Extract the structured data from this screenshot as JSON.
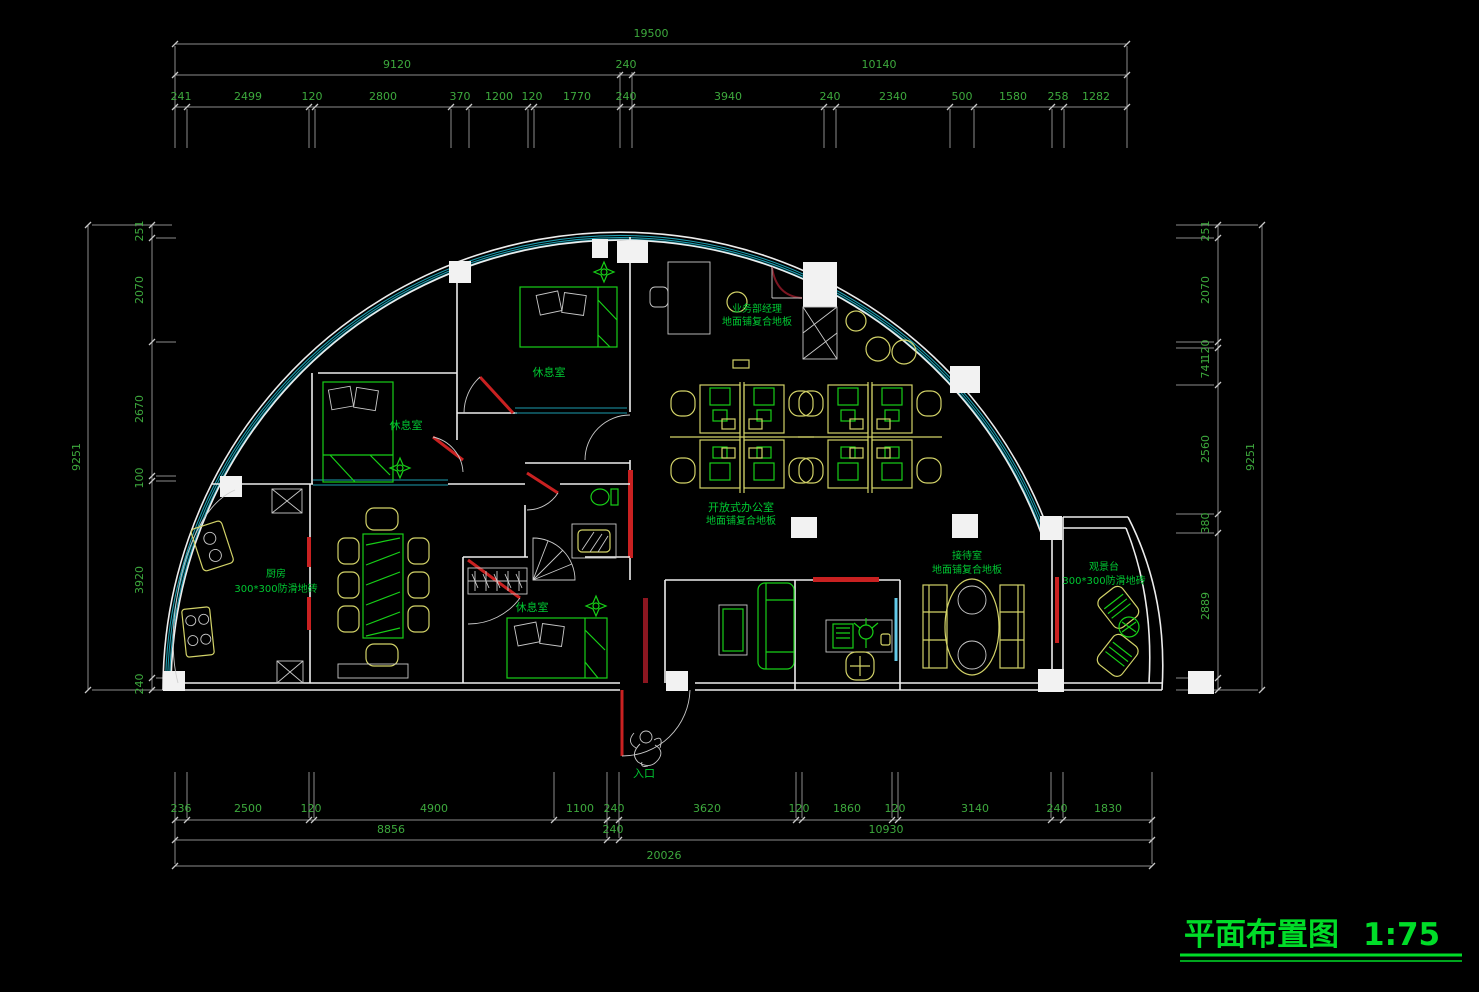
{
  "title": {
    "label": "平面布置图",
    "scale": "1:75"
  },
  "colors": {
    "background": "#000000",
    "dimension_text": "#3da93d",
    "dimension_line": "#8d8d8d",
    "wall": "#ededed",
    "window_teal": "#1d9cae",
    "glass_cyan": "#62c9e8",
    "furniture_yellow": "#d2d268",
    "furniture_green": "#17cf17",
    "door_red": "#c92121",
    "title_green": "#00dc28"
  },
  "rooms": {
    "manager_office": {
      "name": "业务部经理",
      "floor": "地面铺复合地板"
    },
    "open_office": {
      "name": "开放式办公室",
      "floor": "地面铺复合地板"
    },
    "rest_room_top": {
      "name": "休息室"
    },
    "rest_room_mid": {
      "name": "休息室"
    },
    "rest_room_bottom": {
      "name": "休息室"
    },
    "kitchen": {
      "name": "厨房",
      "floor": "300*300防滑地砖"
    },
    "reception": {
      "name": "接待室",
      "floor": "地面铺复合地板"
    },
    "viewing_deck": {
      "name": "观景台",
      "floor": "300*300防滑地砖"
    },
    "entrance": {
      "name": "入口"
    }
  },
  "dimensions": {
    "top": {
      "total": "19500",
      "row2": [
        "9120",
        "240",
        "10140"
      ],
      "row3": [
        "241",
        "2499",
        "120",
        "2800",
        "370",
        "1200",
        "120",
        "1770",
        "240",
        "3940",
        "240",
        "2340",
        "500",
        "1580",
        "258",
        "1282"
      ]
    },
    "bottom": {
      "row1": [
        "236",
        "2500",
        "120",
        "4900",
        "1100",
        "240",
        "3620",
        "120",
        "1860",
        "120",
        "3140",
        "240",
        "1830"
      ],
      "row2": [
        "8856",
        "240",
        "10930"
      ],
      "total": "20026"
    },
    "left": {
      "total": "9251",
      "segments": [
        "251",
        "2070",
        "2670",
        "100",
        "3920",
        "240"
      ]
    },
    "right": {
      "total": "9251",
      "segments": [
        "251",
        "2070",
        "120",
        "741",
        "2560",
        "380",
        "2889",
        "240"
      ]
    }
  }
}
